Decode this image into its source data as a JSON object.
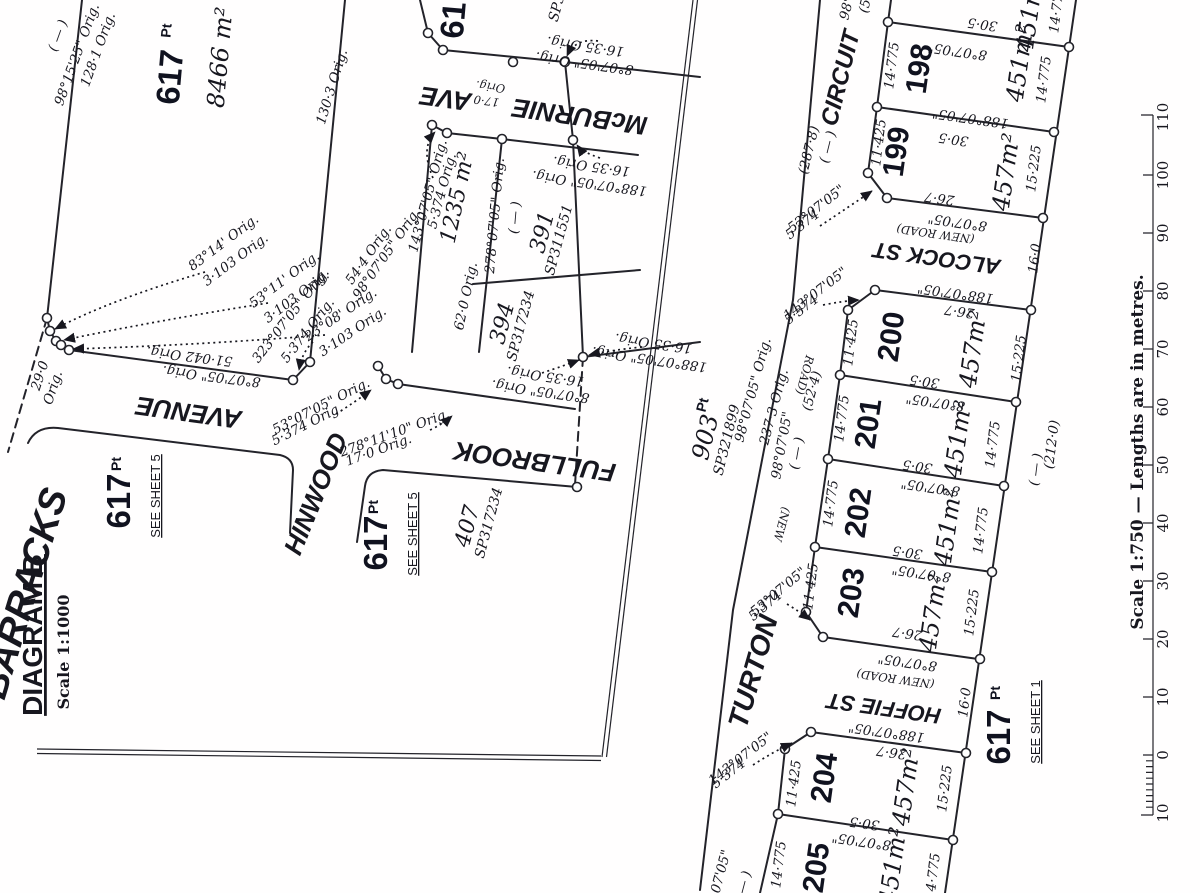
{
  "dims": {
    "b8": "8°07'05\"",
    "b188": "188°07'05\"",
    "w305": "30·5",
    "w267": "26·7",
    "s14775": "14·775",
    "s11425": "11·425",
    "s15225": "15·225",
    "w160": "16·0",
    "a451": "451m²",
    "a457": "457m²",
    "newroad": "(NEW  ROAD)",
    "blank": "( — )",
    "d5374": "5·374",
    "b53": "53°07'05\"",
    "b143": "143°07'05\"",
    "b98": "98°07'05\""
  },
  "left": {
    "title": "DIAGRAM B",
    "scale": "Scale  1:1000",
    "streets": {
      "barracks": "BARRACKS",
      "avenue": "AVENUE",
      "hinwood": "HINWOOD",
      "fullbrook": "FULLBROOK",
      "mcburnie": "McBURNIE",
      "ave": "AVE"
    },
    "lots": {
      "a": {
        "num": "617",
        "pt": "Pt",
        "area": "8466 m²"
      },
      "b": {
        "num": "617",
        "pt": "Pt",
        "see": "SEE SHEET 5"
      },
      "c": {
        "num": "617",
        "pt": "Pt",
        "see": "SEE SHEET 5"
      },
      "top": {
        "num": "617"
      },
      "l1235": "1235 m²",
      "l391": {
        "num": "391",
        "plan": "SP311551"
      },
      "l394": {
        "num": "394",
        "plan": "SP317234"
      },
      "l407": {
        "num": "407",
        "plan": "SP317234"
      },
      "sp3": "SP3"
    },
    "ann": {
      "b9815": "98°15'25\" Orig.",
      "d1281": "128·1 Orig.",
      "b8314": "83°14' Orig.",
      "b5311": "53°11' Orig.",
      "b2308": "23°08' Orig.",
      "d3103": "3·103 Orig.",
      "d51042": "51·042 Orig.",
      "b807o": "8°07'05\" Orig.",
      "b32307": "323°07'05\" Orig.",
      "d5374o": "5·374 Orig.",
      "d290": "29·0",
      "orig": "Orig.",
      "d1303": "130·3 Orig.",
      "d544": "54·4 Orig.",
      "b9807o": "98°07'05\" Orig.",
      "b5307o": "53°07'05\" Orig.",
      "b27811": "278°11'10\" Orig.",
      "d170o": "17·0 Orig.",
      "d170": "17·0",
      "b14307o": "143°07'05\" Orig.",
      "d620": "62·0 Orig.",
      "b27807o": "278°07'05\" Orig.",
      "d1635": "16·35 Orig.",
      "b188o": "188°07'05\" Orig."
    }
  },
  "plan": {
    "streets": {
      "circuit": "CIRCUIT",
      "turton": "TURTON",
      "alcock": "ALCOCK ST",
      "hoffie": "HOFFIE ST"
    },
    "lots": [
      {
        "num": "198",
        "area": "451m²"
      },
      {
        "num": "199",
        "area": "457m²"
      },
      {
        "num": "200",
        "area": "457m²"
      },
      {
        "num": "201",
        "area": "451m²"
      },
      {
        "num": "202",
        "area": "451m²"
      },
      {
        "num": "203",
        "area": "457m²"
      },
      {
        "num": "204",
        "area": "457m²"
      },
      {
        "num": "205",
        "area": "451m²"
      }
    ],
    "ann": {
      "d2878": "(287·8)",
      "b98orig": "98°07'05\" Orig.",
      "d2373": "237·3 Orig.",
      "d524": "(52·4)",
      "new_w": "(NEW",
      "road_w": "ROAD)",
      "lot903": "903",
      "pt": "Pt",
      "sp903": "SP321899",
      "d2120": "(212·0)",
      "l617": "617",
      "see1": "SEE SHEET 1",
      "frag98": "98°",
      "frag5": "(5"
    }
  },
  "scalebar": {
    "caption": "Scale 1:750  —  Lengths are in metres.",
    "ticks": [
      "110",
      "100",
      "90",
      "80",
      "70",
      "60",
      "50",
      "40",
      "30",
      "20",
      "10",
      "0",
      "10"
    ]
  }
}
